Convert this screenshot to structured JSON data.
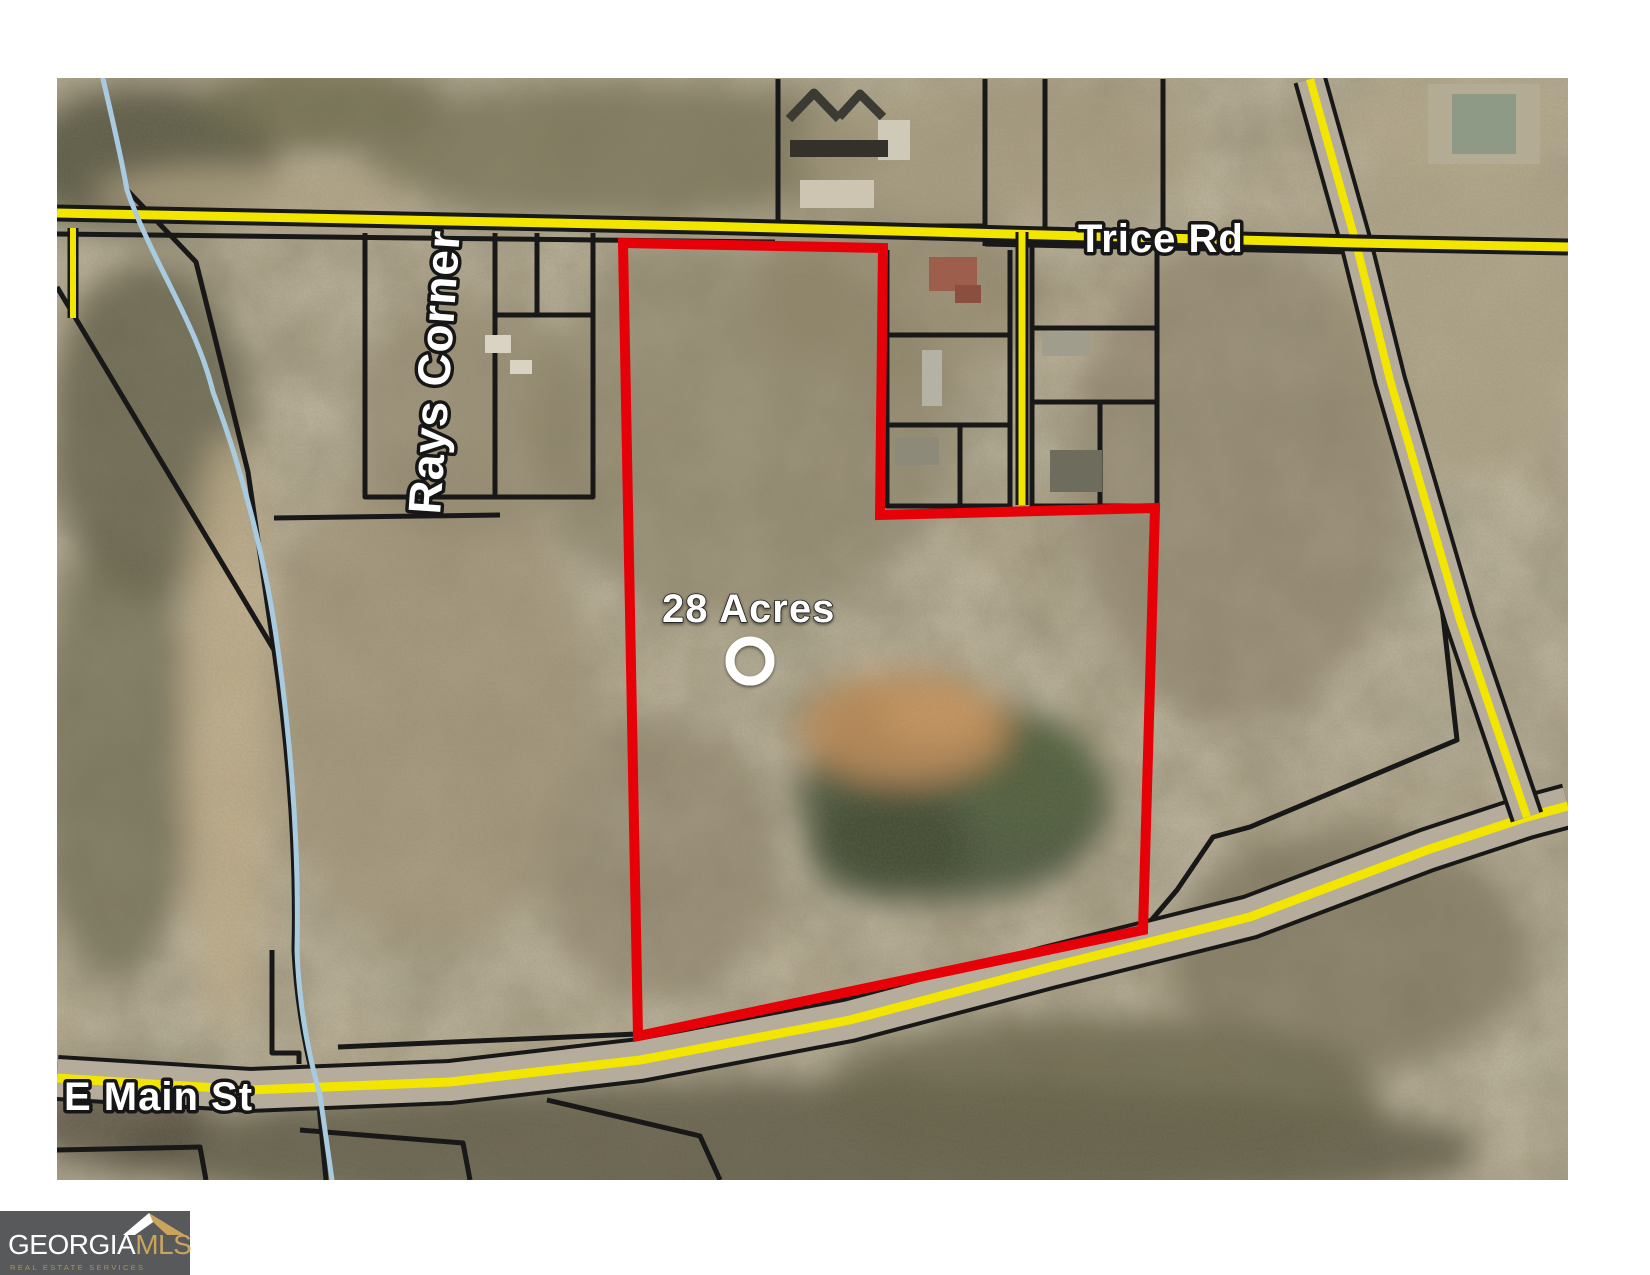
{
  "map": {
    "labels": {
      "road_top": "Trice Rd",
      "road_bottom": "E Main St",
      "area_name": "Rays Corner",
      "acreage": "28 Acres"
    },
    "colors": {
      "boundary_red": "#e60008",
      "road_yellow": "#f2e500",
      "creek_blue": "#a9cbe0",
      "parcel_black": "#181818"
    },
    "paths": {
      "red_boundary": "M623 243 L883 248 L880 515 L1155 508 L1143 930 L638 1036 Z",
      "trice_rd": "M57 213 L700 226 L1356 243 L1568 247",
      "e_main_st": "M57 1078 L250 1090 L450 1082 L640 1060 L850 1020 L1050 967 L1250 917 L1427 850 L1527 817 L1568 806",
      "diagonal_rd": "M1310 79 L1356 243 L1390 380 L1460 620 L1527 817",
      "spur_rd": "M1022 232 L1022 505",
      "left_stub_rd": "M73 228 L73 318",
      "creek": "M103 79 C115 130 122 162 127 190 C152 262 196 322 213 392 C243 472 266 562 278 650 C293 760 299 860 297 950 C299 1010 310 1060 320 1095 L332 1180",
      "creek_parcel_line": "M127 190 L196 262 L216 342 L248 472 L274 650 C290 760 296 862 294 950 C297 1010 308 1062 318 1094 L326 1180",
      "diagonal_line_bl": "M57 287 L274 650",
      "line_mid_left": "M274 518 L500 515",
      "below_trice_left": "M57 234 L775 242",
      "below_trice_right": "M985 244 L1350 252",
      "rays_block": "M365 233 L365 497 L593 497 L593 233 M495 233 L495 497 M495 315 L593 315 M537 233 L537 315",
      "top_block": "M778 79 L778 226 L985 226 L985 79 M985 226 L985 246",
      "topright_verticals": "M1045 79 L1045 234 M1163 79 L1163 240",
      "mid_parcels_left": "M887 250 L887 506 L1010 506 L1010 250 M887 335 L1010 335 M887 425 L1010 425 M960 425 L960 506",
      "mid_parcels_right": "M1032 246 L1032 506 L1157 506 L1157 241 M1032 328 L1157 328 M1032 402 L1157 402 M1100 402 L1100 506",
      "right_parcel": "M1356 252 L1435 550 L1442 607 L1457 740 L1250 827 L1213 837 L1177 890 L1143 930",
      "above_main_line": "M338 1047 L637 1034",
      "bottom_left_parcels": "M272 950 L272 1053 L299 1053 L299 1064 M57 1150 L200 1147 L206 1180 M300 1130 L463 1143 L470 1180 M547 1100 L700 1136 L720 1180"
    }
  },
  "logo": {
    "brand_primary": "GEORGIA",
    "brand_secondary": "MLS",
    "tagline": "REAL ESTATE SERVICES",
    "colors": {
      "bg": "#58595b",
      "primary": "#ffffff",
      "secondary": "#c9a45c"
    }
  }
}
